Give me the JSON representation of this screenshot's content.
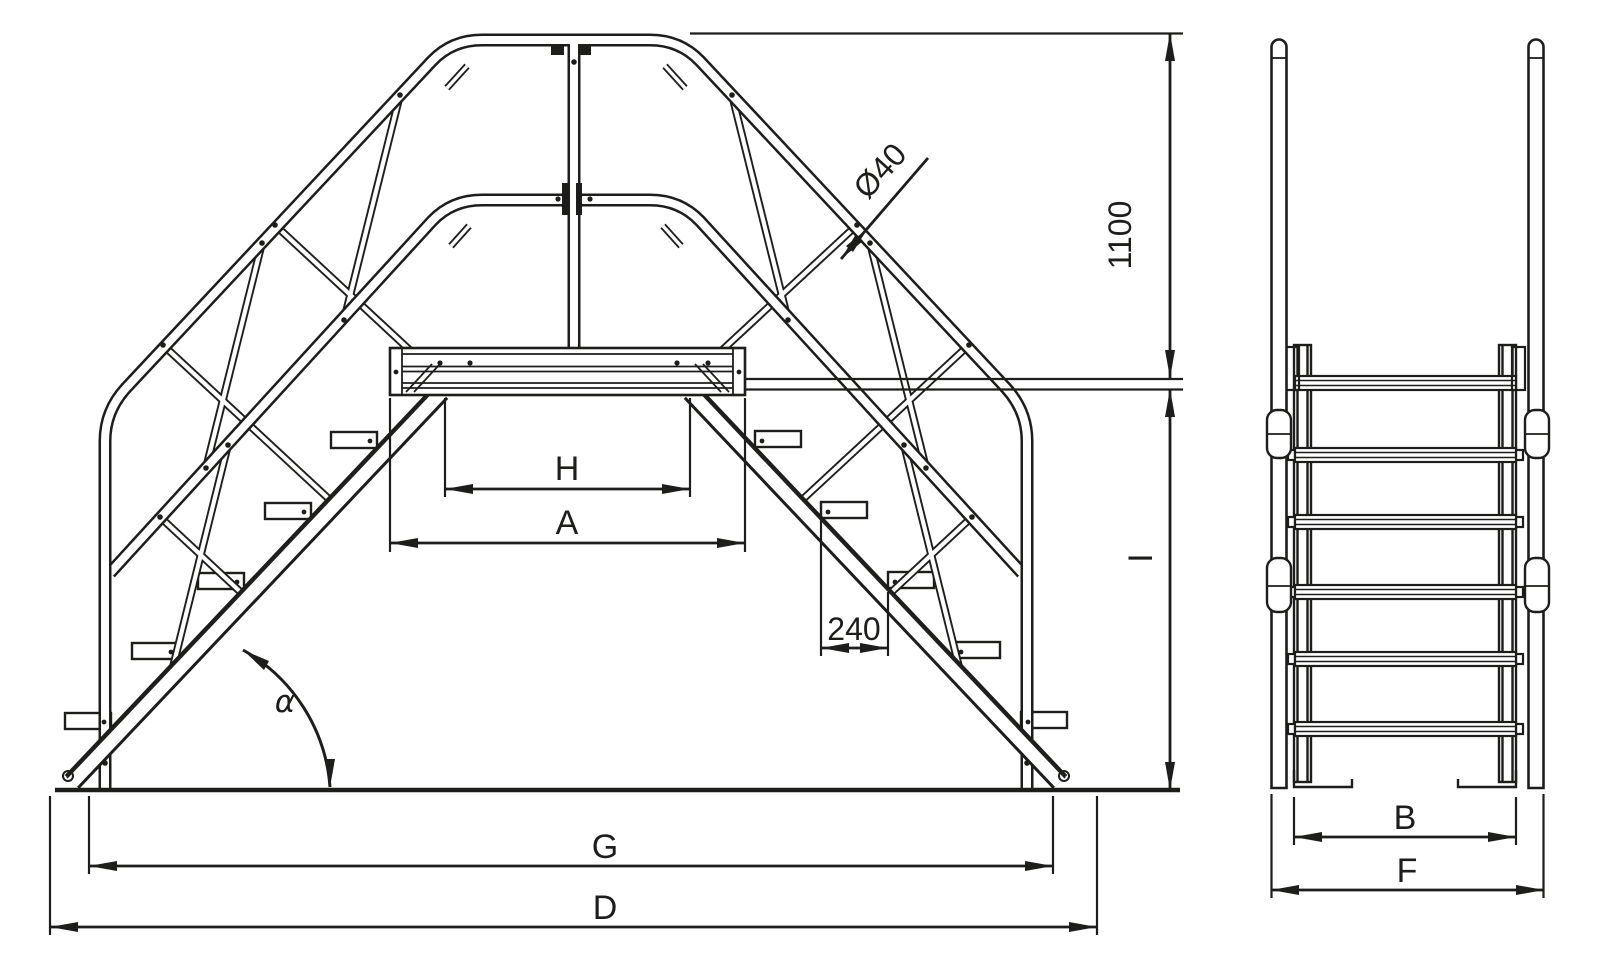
{
  "drawing": {
    "background": "#ffffff",
    "stroke_color": "#1d1d1b",
    "dimensions": {
      "platform_clear_width": "H",
      "platform_overall_width": "A",
      "tread_pitch": "240",
      "stair_angle": "α",
      "base_span_inner": "G",
      "base_span_overall": "D",
      "handrail_tube_diameter": "Ø40",
      "handrail_height": "1100",
      "platform_height": "I",
      "stair_width_inner": "B",
      "stair_width_overall": "F"
    }
  }
}
